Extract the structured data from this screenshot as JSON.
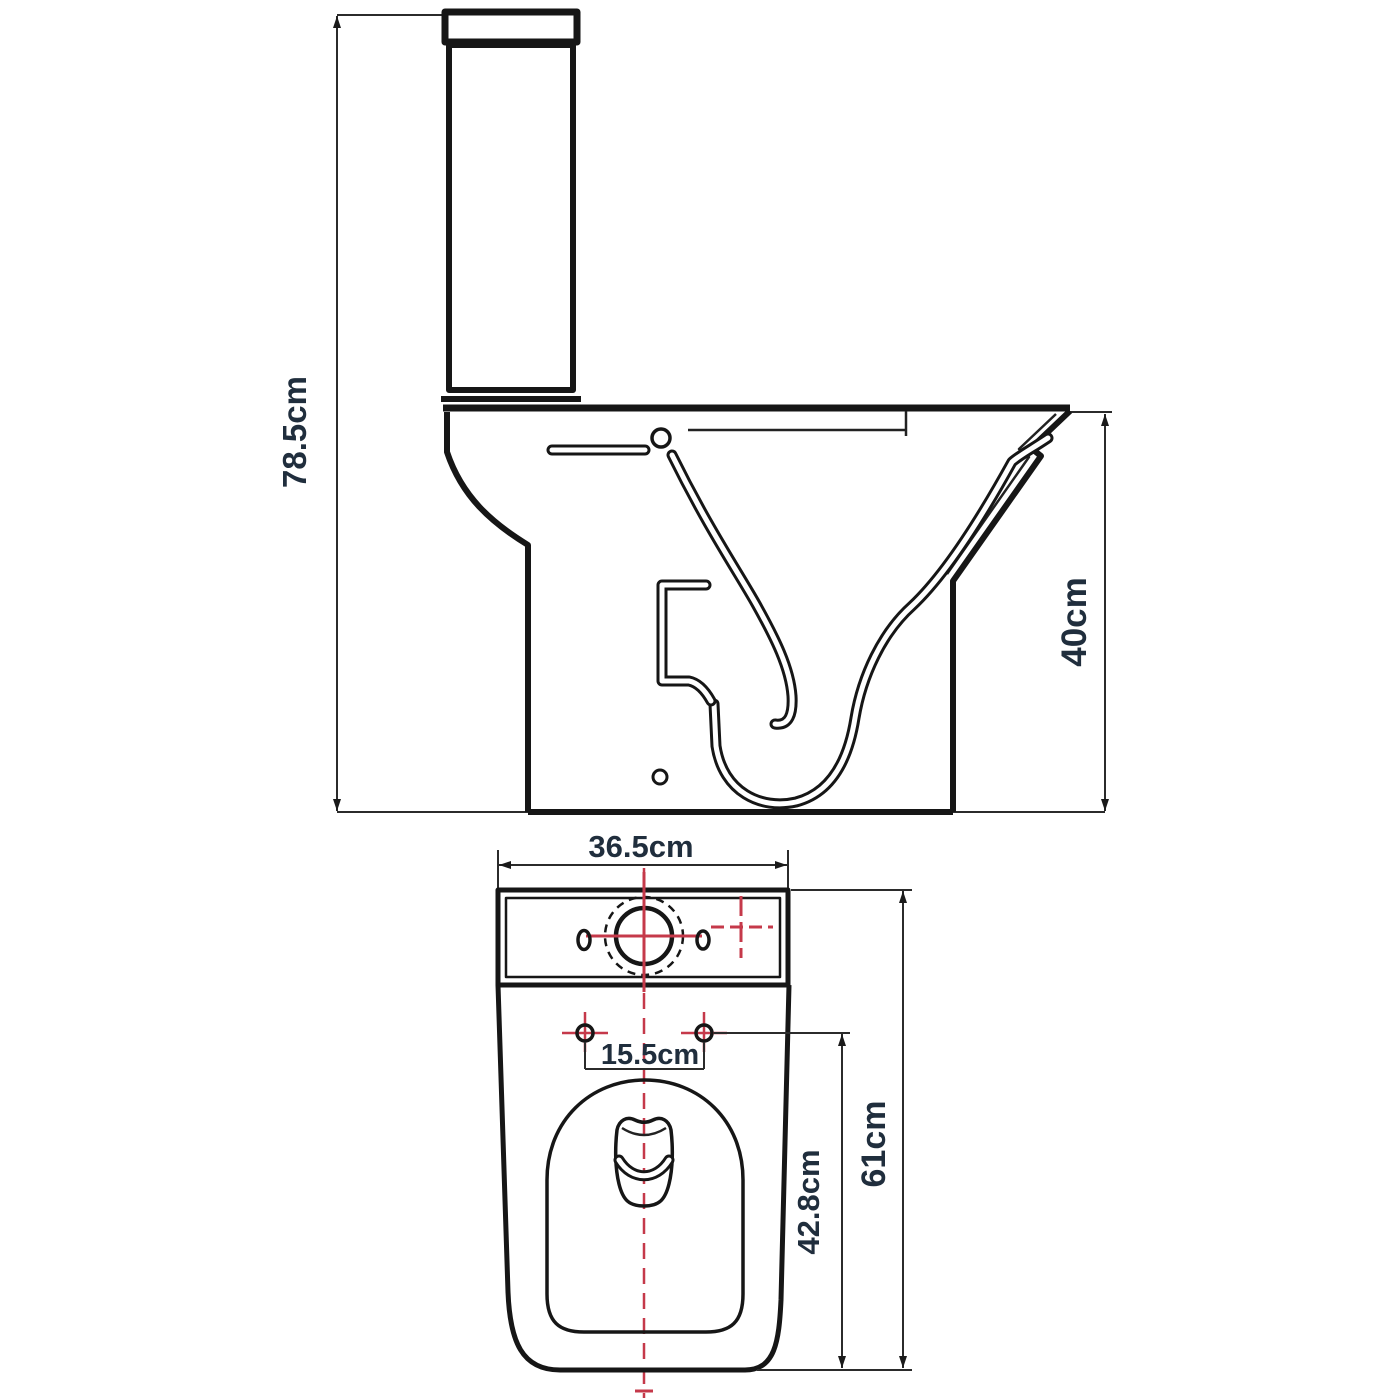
{
  "drawing": {
    "kind": "toilet-technical-dimension-drawing",
    "units": "cm",
    "labels": {
      "overall_height": "78.5cm",
      "bowl_height": "40cm",
      "cistern_width": "36.5cm",
      "fixing_hole_centres": "15.5cm",
      "pan_depth": "42.8cm",
      "overall_depth": "61cm"
    },
    "colors": {
      "line": "#161616",
      "dimension_line": "#2b2b2b",
      "label_text": "#202e3d",
      "centerline_red": "#c5394a",
      "background": "#ffffff"
    },
    "views": [
      {
        "name": "side-elevation",
        "dimensions": [
          "78.5cm",
          "40cm"
        ]
      },
      {
        "name": "plan-top-view",
        "dimensions": [
          "36.5cm",
          "15.5cm",
          "42.8cm",
          "61cm"
        ]
      }
    ]
  }
}
